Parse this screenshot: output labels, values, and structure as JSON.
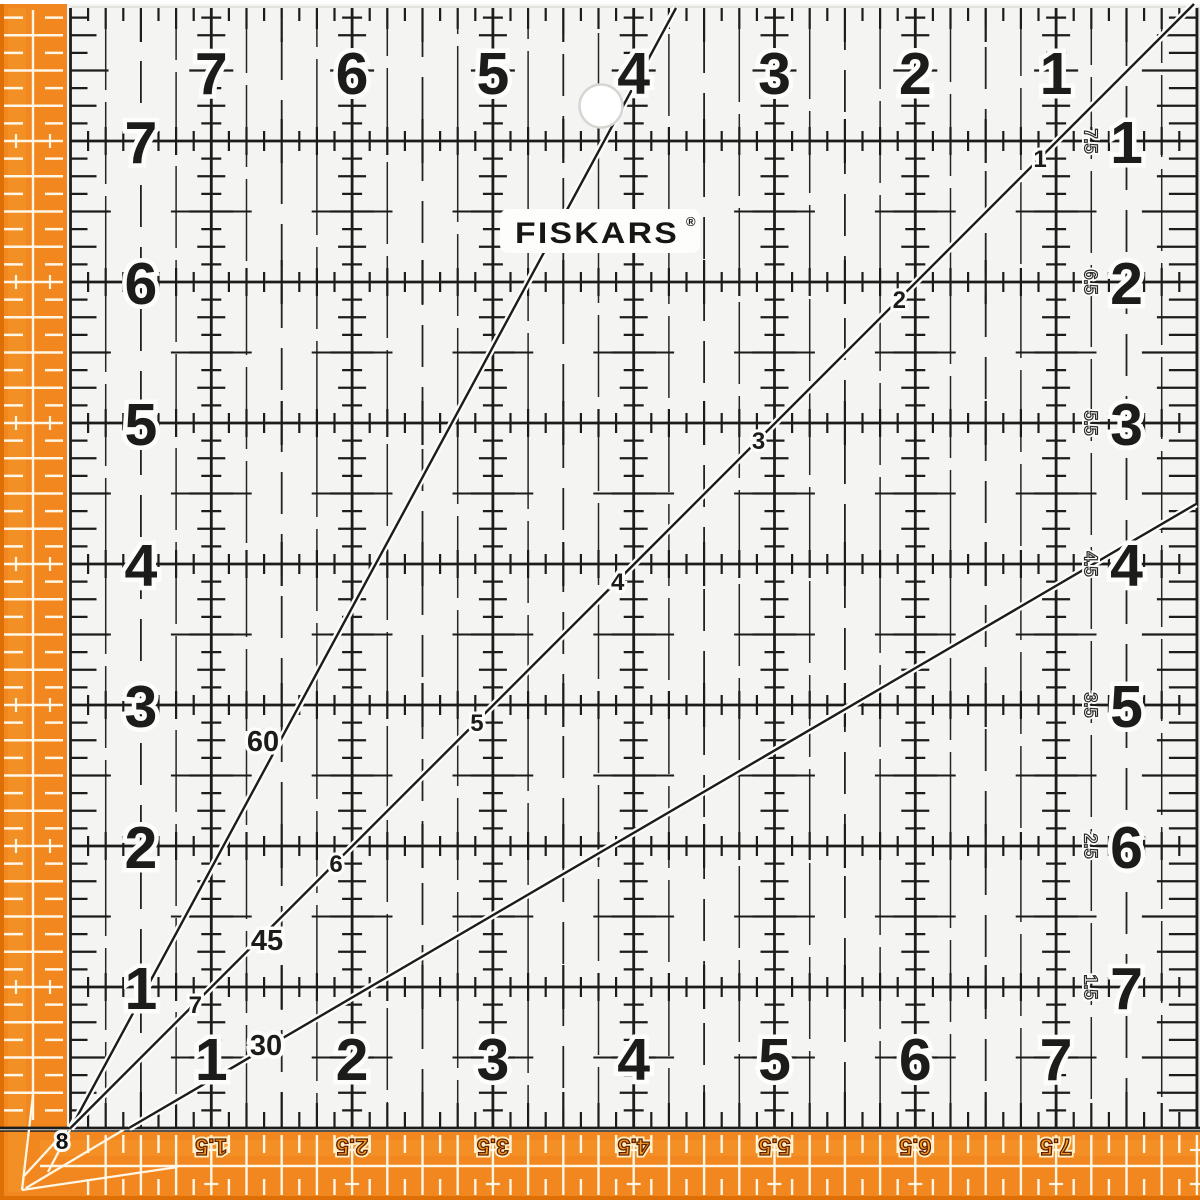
{
  "product": {
    "brand_logo": "FISKARS",
    "registered_mark": "®",
    "description": "square acrylic quilting ruler with inch grid, angle lines and orange edge scales"
  },
  "colors": {
    "orange": "#F1871E",
    "orange_edge": "#DD6F05",
    "orange_light": "#F79B2E",
    "ink": "#1C1C1A",
    "plate": "#F4F4F2",
    "halo": "#FDFDFC",
    "strip_tick": "#FFF6E6",
    "hole_ring": "#D6D6D2",
    "strip_label_fill": "#F39C1F",
    "strip_label_outline": "#5E1D00",
    "strip_label_halo": "#FFECBF"
  },
  "scales": {
    "top_numbers": [
      "7",
      "6",
      "5",
      "4",
      "3",
      "2",
      "1"
    ],
    "left_numbers": [
      "7",
      "6",
      "5",
      "4",
      "3",
      "2",
      "1"
    ],
    "bottom_numbers": [
      "1",
      "2",
      "3",
      "4",
      "5",
      "6",
      "7"
    ],
    "right_numbers": [
      "1",
      "2",
      "3",
      "4",
      "5",
      "6",
      "7"
    ],
    "right_half_inch_labels": [
      "7.5",
      "6.5",
      "5.5",
      "4.5",
      "3.5",
      "2.5",
      "1.5"
    ],
    "bottom_strip_labels": [
      "1.5",
      "2.5",
      "3.5",
      "4.5",
      "5.5",
      "6.5",
      "7.5"
    ],
    "corner_label": "8",
    "diagonal_inch_labels": [
      "1",
      "2",
      "3",
      "4",
      "5",
      "6",
      "7"
    ],
    "angle_labels": {
      "sixty": "60",
      "forty_five": "45",
      "thirty": "30"
    }
  }
}
